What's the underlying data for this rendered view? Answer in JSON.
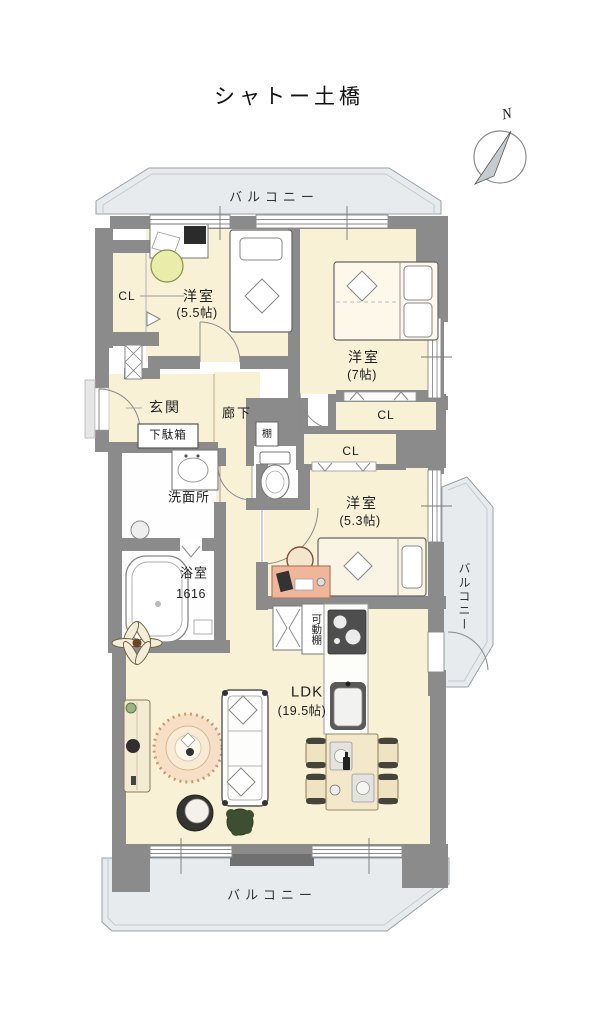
{
  "title": "シャトー土橋",
  "compass": {
    "north": "N"
  },
  "balconies": {
    "top": "バルコニー",
    "right": "バルコニー",
    "bottom": "バルコニー"
  },
  "rooms": {
    "bedroom1": {
      "name": "洋室",
      "size": "(5.5帖)"
    },
    "bedroom2": {
      "name": "洋室",
      "size": "(7帖)"
    },
    "bedroom3": {
      "name": "洋室",
      "size": "(5.3帖)"
    },
    "ldk": {
      "name": "LDK",
      "size": "(19.5帖)"
    },
    "bathroom": {
      "name": "浴室",
      "size": "1616"
    },
    "washroom": {
      "name": "洗面所"
    },
    "entrance": {
      "name": "玄関"
    },
    "hallway": {
      "name": "廊下"
    }
  },
  "fixtures": {
    "closet_bedroom1": "CL",
    "closet_bedroom2": "CL",
    "closet_bedroom3": "CL",
    "shoe_cabinet": "下駄箱",
    "shelf": "棚",
    "movable_shelf": "可動棚"
  },
  "colors": {
    "wall": "#8b8b8b",
    "floor": "#f9f1d6",
    "balcony": "#e8ebee",
    "white_room": "#fefefe",
    "desk_accent": "#f0b69c",
    "stool_accent": "#e9edaa",
    "plant": "#3c4f31",
    "rug": "#f6dfc4"
  }
}
